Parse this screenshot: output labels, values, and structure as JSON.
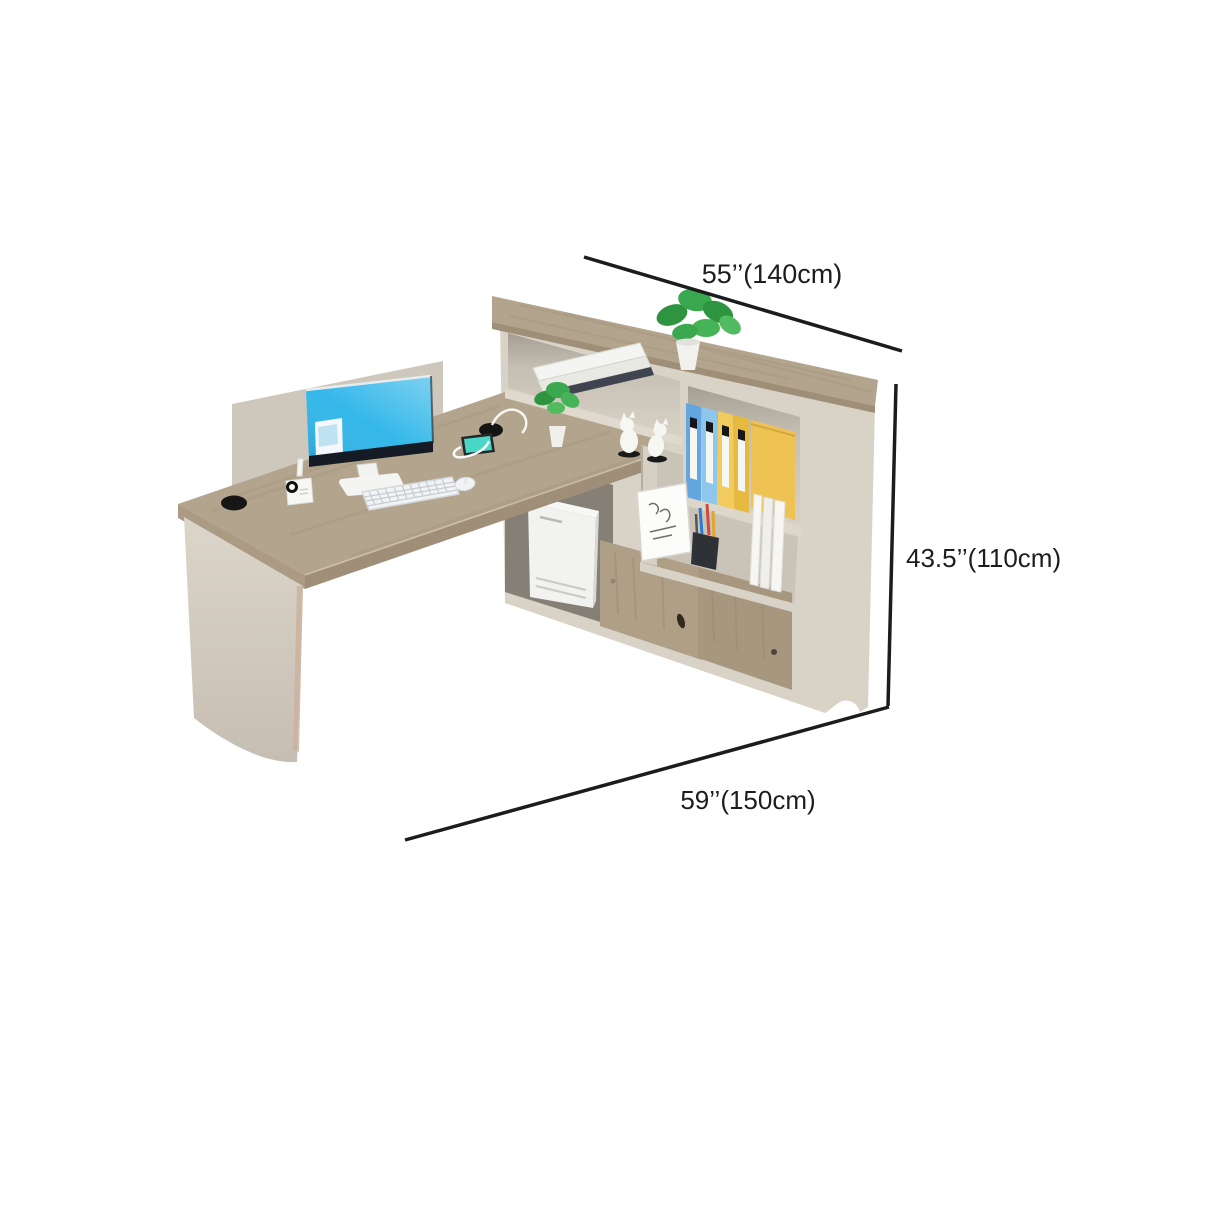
{
  "canvas": {
    "width": 1214,
    "height": 1214,
    "background": "#ffffff"
  },
  "dimensions": {
    "width_top": {
      "label": "55’’(140cm)"
    },
    "height_right": {
      "label": "43.5’’(110cm)"
    },
    "depth_bottom": {
      "label": "59’’(150cm)"
    }
  },
  "colors": {
    "dimension_line": "#1c1c1c",
    "dimension_text": "#1d1d1f",
    "wood": "#b3a48d",
    "wood_edge": "#a08f78",
    "cabinet_body": "#d9d2c6",
    "shelf_interior": "#cfc8bc",
    "dark_compartment": "#857f75",
    "door_wood": "#b09f87",
    "privacy_panel": "#cdc7bc",
    "monitor_screen": "#29b4e8",
    "monitor_bezel": "#141b24",
    "binder_blue": "#64a7e0",
    "binder_light_blue": "#8ec6ec",
    "binder_yellow": "#f2cb5e",
    "binder_amber": "#e6b93f",
    "binder_cover": "#eec354",
    "plant_green": "#3aa84e",
    "device_white": "#f2f2f0",
    "phone_screen": "#49d8c6"
  }
}
